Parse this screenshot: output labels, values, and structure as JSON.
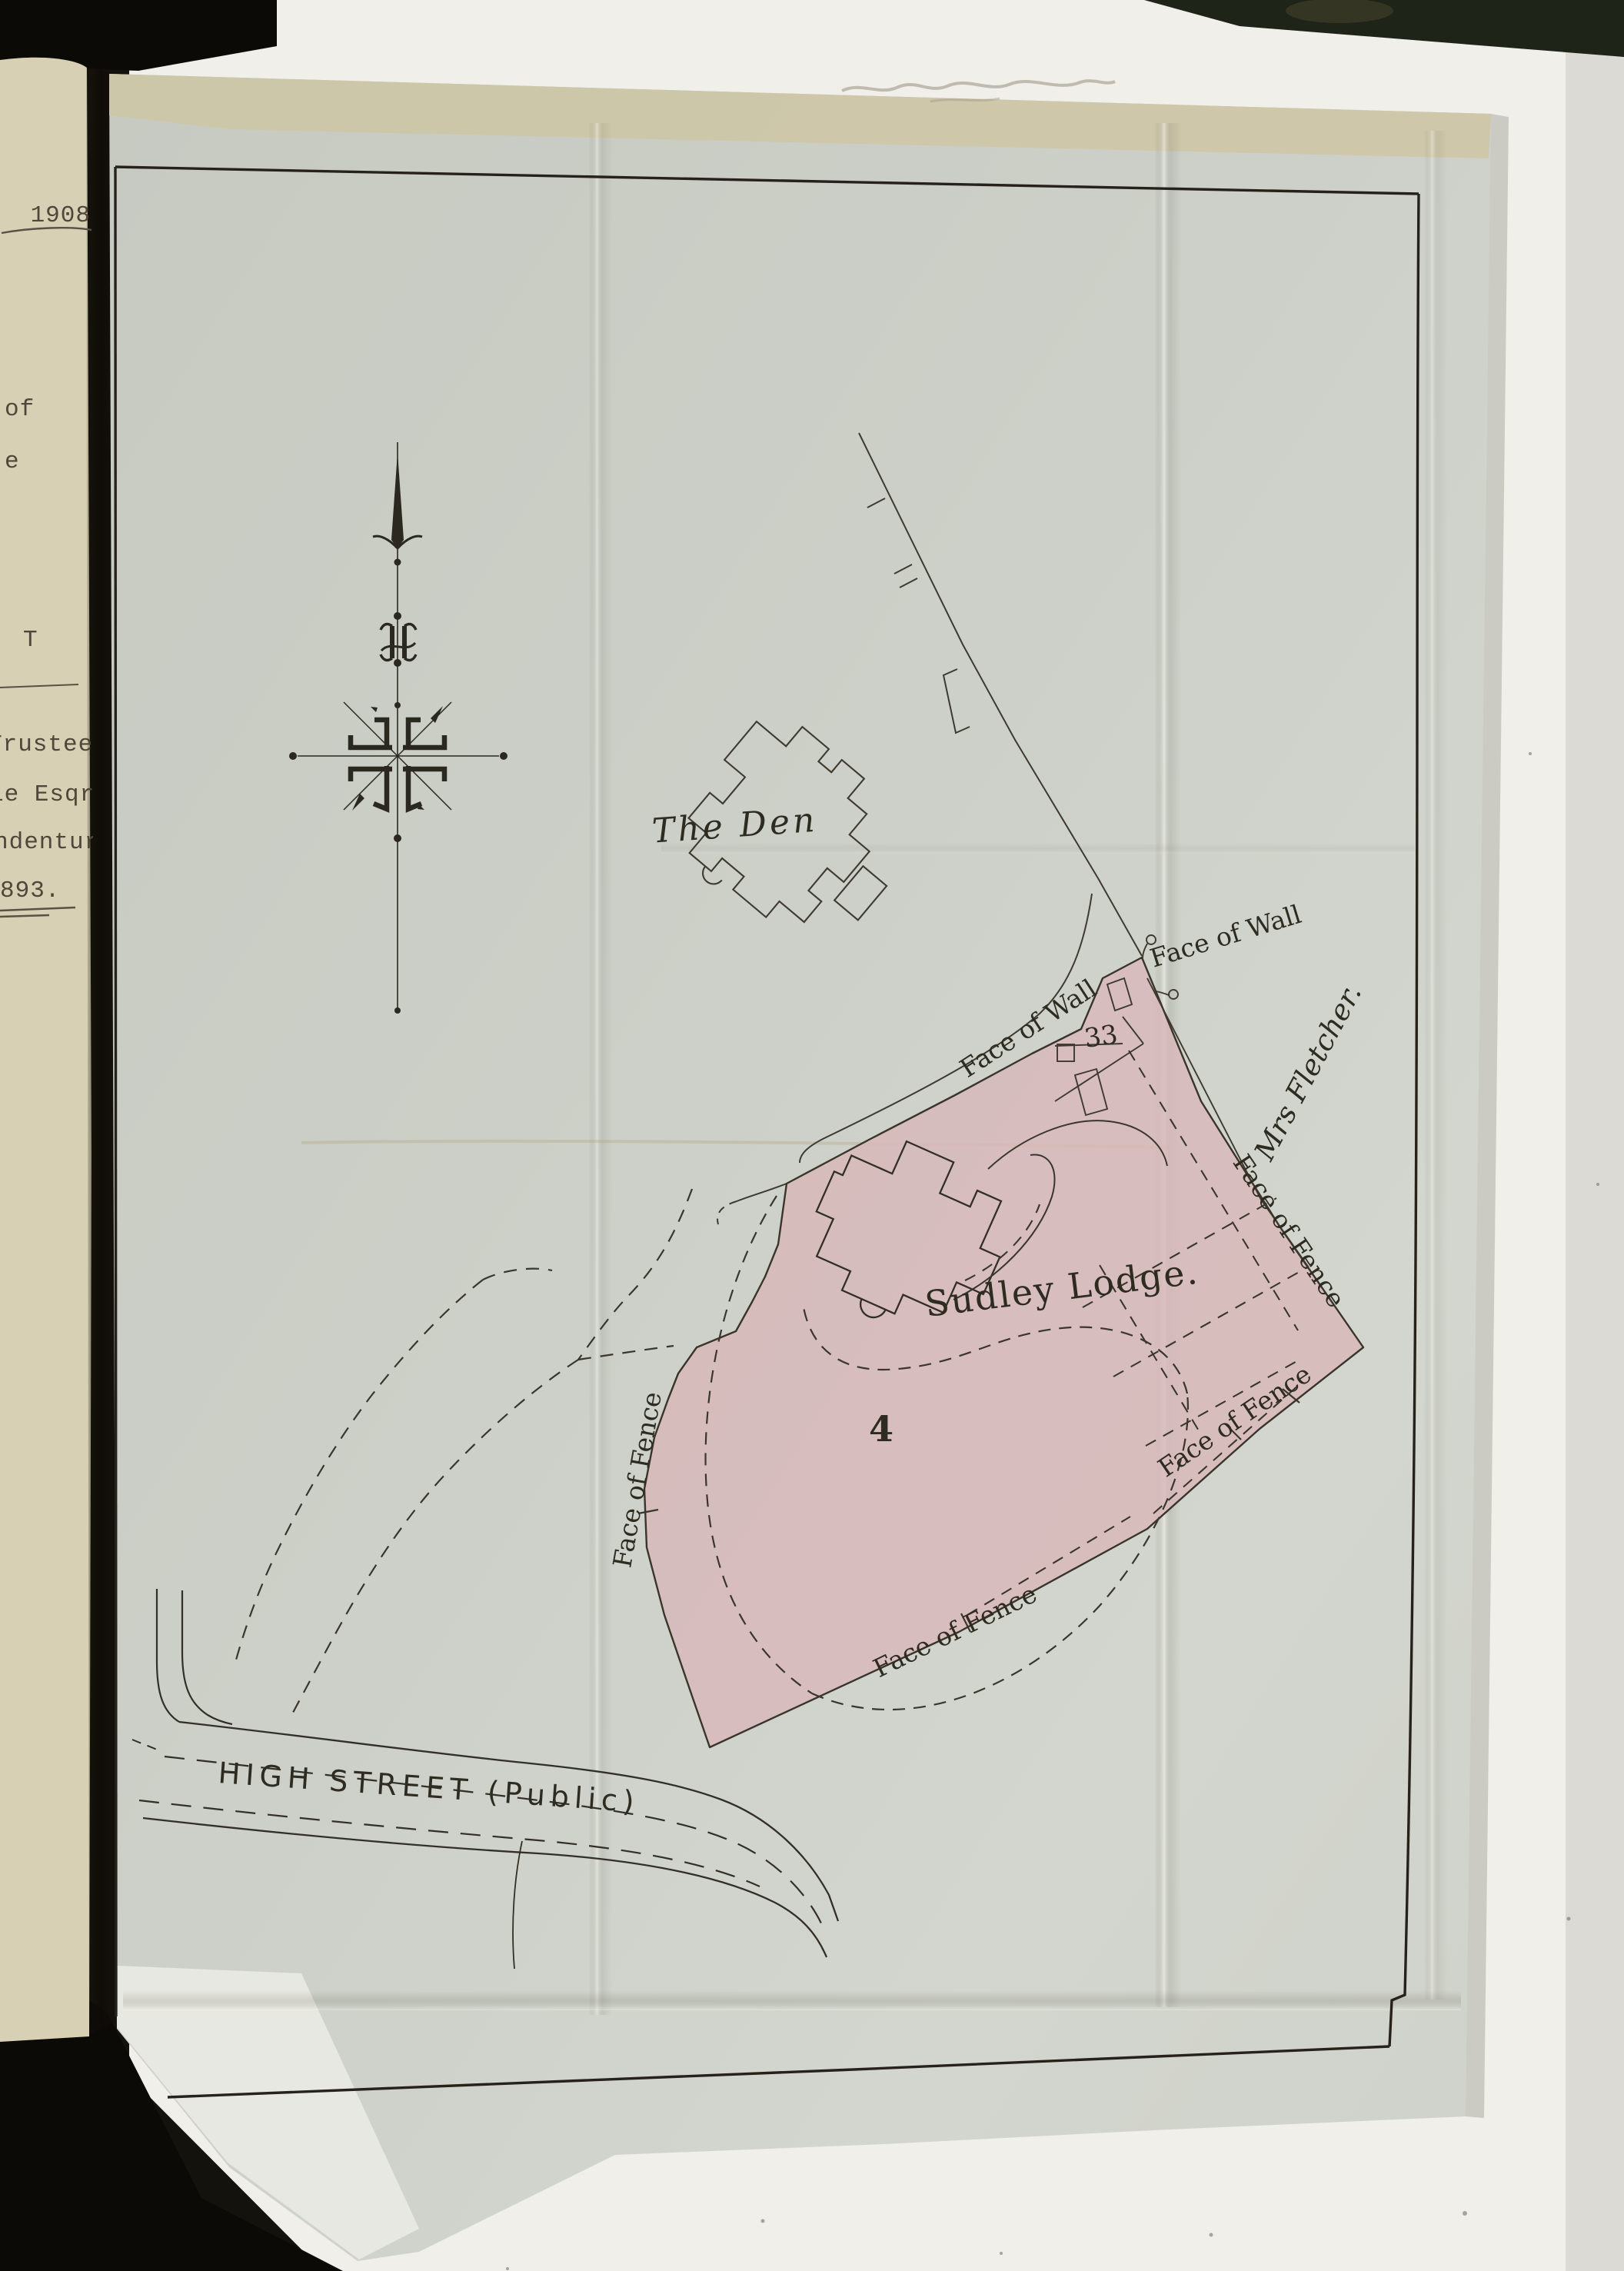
{
  "left_page": {
    "fragments": [
      "1908",
      "of",
      "e",
      "T",
      "Trustee",
      "ie Esqre",
      "ndenture",
      "893."
    ]
  },
  "map": {
    "labels": {
      "the_den": "The Den",
      "face_of_wall_upper": "Face of Wall",
      "face_of_wall_lower": "Face of Wall",
      "parcel_33": "33",
      "mrs_fletcher": "Mrs Fletcher.",
      "sudley_lodge": "Sudley Lodge.",
      "plot_4": "4",
      "fence_west": "Face of Fence",
      "fence_south": "Face of Fence",
      "fence_east": "Face of Fence",
      "fence_southeast": "Face of Fence",
      "high_street": "HIGH STREET (Public)"
    },
    "colors": {
      "plot_fill": "#d8b8ba",
      "map_paper": "#cbcfc7",
      "ink": "#332f26",
      "typed_page_paper": "#d7d0b4",
      "backing_sheet": "#f0efe9",
      "background": "#14120c"
    }
  }
}
